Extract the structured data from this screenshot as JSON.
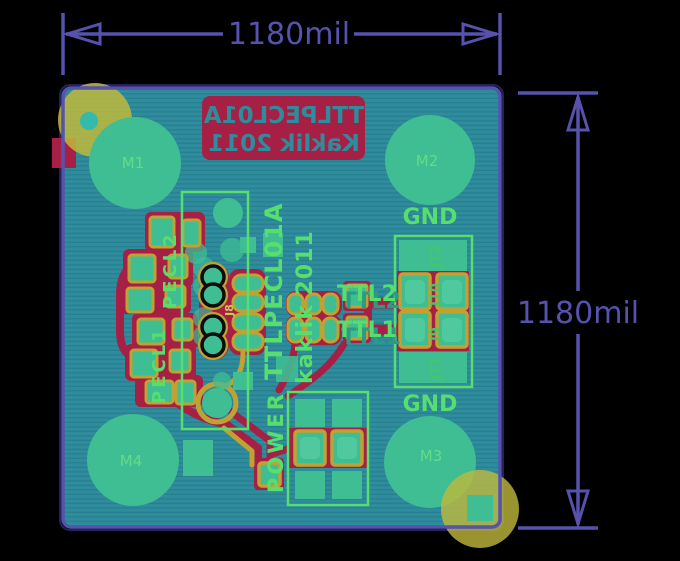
{
  "scene": {
    "description": "PCB layout preview (bottom view) with dimension annotations"
  },
  "dimensions": {
    "top_label": "1180mil",
    "right_label": "1180mil"
  },
  "silkscreen_mirrored": {
    "line1": "TTLPECL01A",
    "line2": "Kaklik 2011"
  },
  "silkscreen": {
    "board_title": "TTLPECL01A",
    "board_author": "kaklik 2011",
    "pecl2": "PECL2",
    "pecl1": "PECL1",
    "power": "POWER",
    "ttl2": "TTL2",
    "ttl1": "TTL1",
    "gnd_top": "GND",
    "gnd_bottom": "GND",
    "j8": "J8",
    "j9": "J9",
    "j10": "J10",
    "j11": "J11",
    "j12": "J12"
  },
  "mount_pads": {
    "m1": "M1",
    "m2": "M2",
    "m3": "M3",
    "m4": "M4"
  },
  "colors": {
    "background": "#000000",
    "dimension_purple": "#5652ae",
    "board_teal": "#2e8c9c",
    "board_stripe": "#26808f",
    "copper_red": "#a62045",
    "pad_teal": "#3fbd93",
    "pad_rim_yellow": "#c0a232",
    "silk_green": "#58de6d",
    "mount_hole_yellow": "#bfb93c",
    "drill_dot_teal": "#35b9ab"
  }
}
